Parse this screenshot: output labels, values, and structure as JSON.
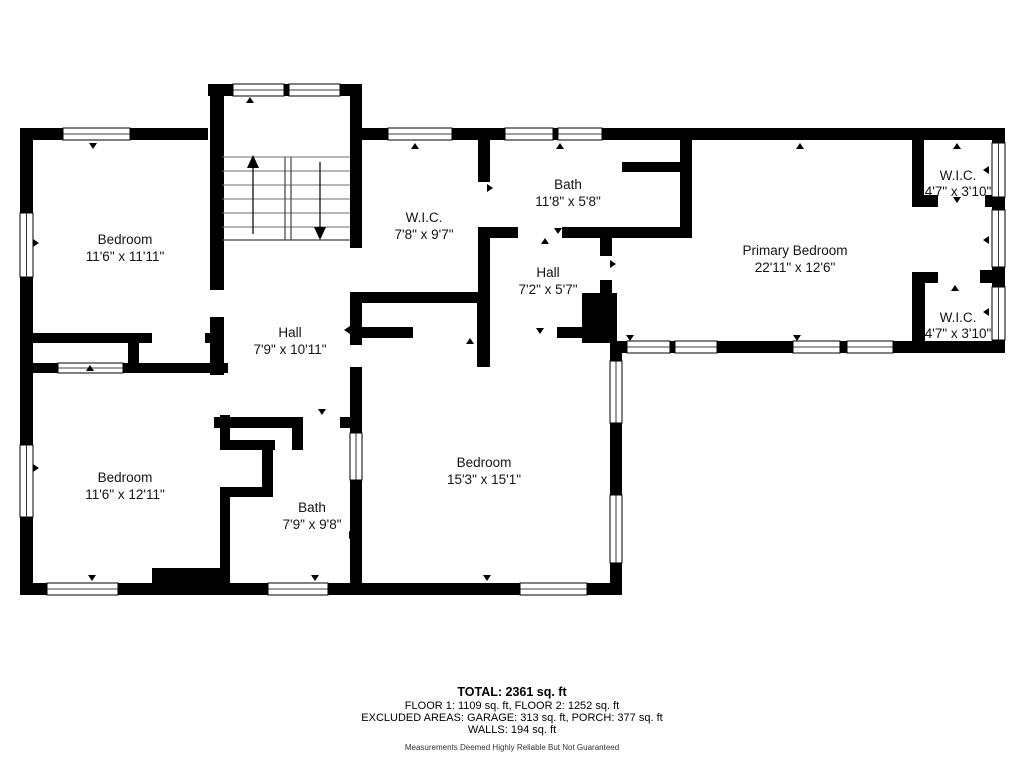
{
  "rooms": {
    "bedroom_tl": {
      "name": "Bedroom",
      "dims": "11'6\" x 11'11\""
    },
    "bedroom_bl": {
      "name": "Bedroom",
      "dims": "11'6\" x 12'11\""
    },
    "bedroom_big": {
      "name": "Bedroom",
      "dims": "15'3\" x 15'1\""
    },
    "primary": {
      "name": "Primary Bedroom",
      "dims": "22'11\" x 12'6\""
    },
    "wic_center": {
      "name": "W.I.C.",
      "dims": "7'8\" x 9'7\""
    },
    "wic_top_right": {
      "name": "W.I.C.",
      "dims": "4'7\" x 3'10\""
    },
    "wic_bot_right": {
      "name": "W.I.C.",
      "dims": "4'7\" x 3'10\""
    },
    "bath_top": {
      "name": "Bath",
      "dims": "11'8\" x 5'8\""
    },
    "bath_bottom": {
      "name": "Bath",
      "dims": "7'9\" x 9'8\""
    },
    "hall_main": {
      "name": "Hall",
      "dims": "7'9\" x 10'11\""
    },
    "hall_small": {
      "name": "Hall",
      "dims": "7'2\" x 5'7\""
    }
  },
  "summary": {
    "total": "TOTAL: 2361 sq. ft",
    "floors": "FLOOR 1: 1109 sq. ft, FLOOR 2: 1252 sq. ft",
    "excluded": "EXCLUDED AREAS: GARAGE: 313 sq. ft, PORCH: 377 sq. ft",
    "walls": "WALLS: 194 sq. ft",
    "disclaimer": "Measurements Deemed Highly Reliable But Not Guaranteed"
  },
  "colors": {
    "wall": "#000000",
    "background": "#ffffff"
  }
}
